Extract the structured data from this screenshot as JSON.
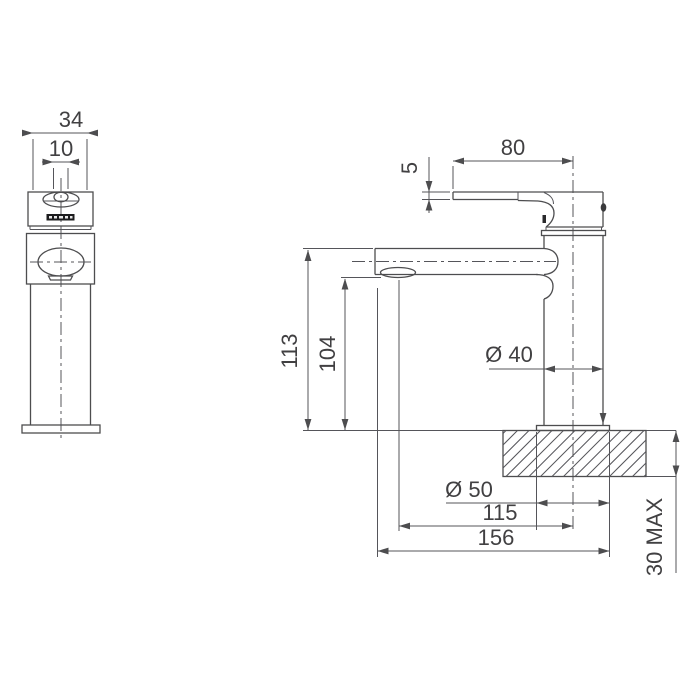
{
  "colors": {
    "background": "#ffffff",
    "line": "#4d4d4f",
    "text": "#414042",
    "badge": "#1c1c1e"
  },
  "dims": {
    "front_width": "34",
    "lever_width": "10",
    "handle_length": "80",
    "lever_thickness": "5",
    "spout_height": "113",
    "aerator_height": "104",
    "body_diameter": "Ø 40",
    "base_diameter": "Ø 50",
    "spout_reach": "115",
    "overall_projection": "156",
    "bench_thickness": "30 MAX"
  }
}
